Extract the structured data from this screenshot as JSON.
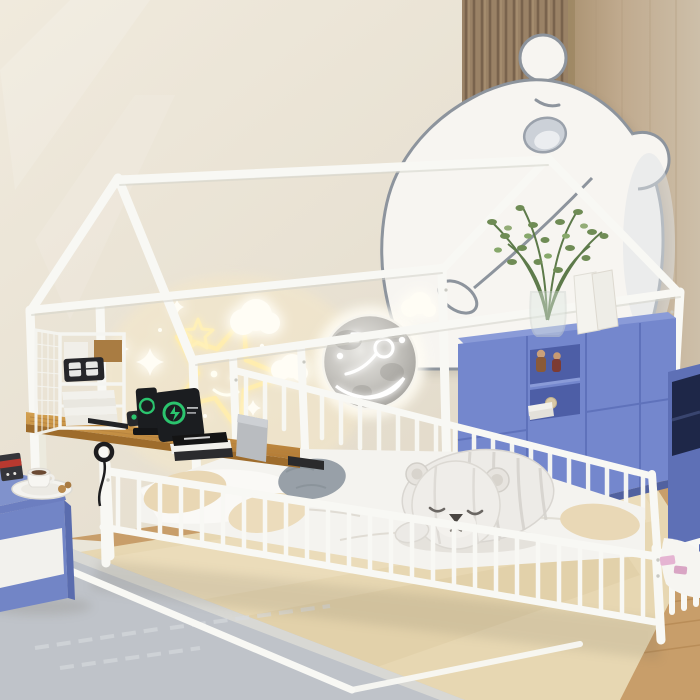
{
  "scene": {
    "type": "product-photo",
    "setting": "kids bedroom",
    "subject": "white metal house-frame floor bed with guard fence, attached wooden desk, wire storage shelf, bear wall cutout, neon star decor and moon night light",
    "objects": {
      "wall_decor": [
        "bear-cutout",
        "neon-star-large",
        "neon-star-small",
        "glow-clouds",
        "glow-stars",
        "moon-lamp"
      ],
      "furniture": [
        "house-bed-frame",
        "guard-fence",
        "attached-desk",
        "wire-storage-shelf",
        "blue-nightstand",
        "blue-cabinet",
        "blue-side-unit"
      ],
      "props": [
        "plush-bear",
        "pillows",
        "duvet",
        "potted-plant",
        "glass-vase",
        "white-cards",
        "book-stack",
        "laptop",
        "tablet",
        "phone-dock",
        "watch-charger",
        "flip-clock",
        "coffee-cup",
        "plate",
        "snack-box",
        "toy-figurines",
        "toy-ball",
        "pink-blocks",
        "cable-hook"
      ],
      "flooring": [
        "wood-floor",
        "beige-rug",
        "gray-rug",
        "baseboard"
      ],
      "wall_finishes": [
        "beige-wall",
        "wood-slat-panel",
        "wood-panel"
      ]
    }
  },
  "colors": {
    "wall": "#e8e1d2",
    "slatWood": "#9a8266",
    "slatLine": "#79634d",
    "panelWood": "#bfa98d",
    "panelEdge": "#9a845f",
    "frameWhite": "#f8f8f4",
    "frameShade": "#c9c8c0",
    "bearFill": "#f7f5f1",
    "bearLine": "#8d949d",
    "bearMuzzle": "#ccd1d8",
    "bearMuzzleInner": "#ebedf0",
    "neon": "#ffedaf",
    "starWhite": "#fffdf5",
    "deskTop": "#c9953f",
    "deskEdge": "#9e6c2c",
    "deviceBlack": "#1b1d20",
    "deviceGreen": "#2bc46e",
    "laptopGray": "#b9bcc0",
    "pageWhite": "#f2f1ec",
    "nightstandBlue": "#7285c6",
    "nightstandDark": "#5a6cae",
    "drawerWhite": "#f2f1ed",
    "cabinetBlue": "#7487cd",
    "cabinetTopFace": "#8a9bd8",
    "cabinetInterior": "#4d5ea6",
    "cabinetSeam": "#5f72bb",
    "unitBlue": "#5e70b6",
    "unitDark": "#1e2748",
    "plantGreen": "#6f8c55",
    "mattress": "#f4f3ef",
    "pillowBeige": "#e9d7b4",
    "pillowGray": "#98a0a8",
    "plushBody": "#edebe7",
    "plushStripe": "#d6d3ce",
    "plushNose": "#4a4642",
    "rugBeige": "#e7d7b2",
    "rugGray": "#bfc3c9",
    "rugBorder": "#dcdcd6",
    "floorWood": "#c89e6a",
    "floorPlank": "#b2854f",
    "baseboard": "#eae6d9",
    "pinkToy": "#e5b4d2"
  }
}
